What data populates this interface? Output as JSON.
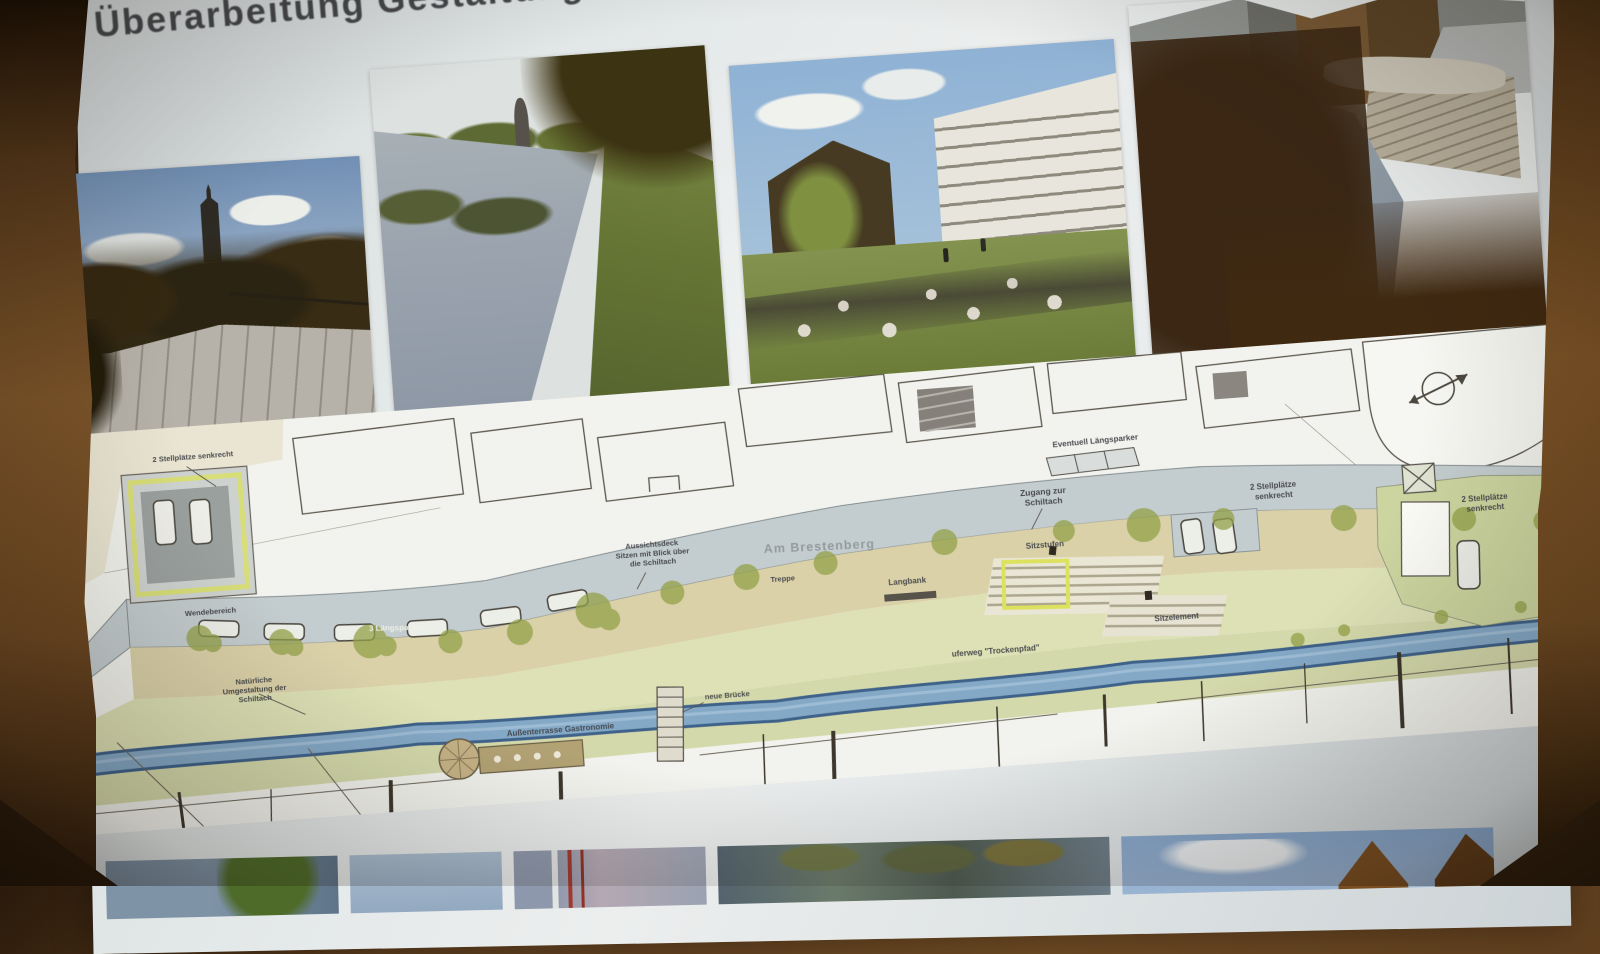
{
  "slide": {
    "title": "Überarbeitung Gestaltung"
  },
  "photos_top": [
    {
      "name": "deck-church-tower"
    },
    {
      "name": "river-bank"
    },
    {
      "name": "apartments-stream"
    },
    {
      "name": "stream-stone-steps"
    }
  ],
  "photos_bottom": [
    {
      "name": "water-tree"
    },
    {
      "name": "sky"
    },
    {
      "name": "facade-detail"
    },
    {
      "name": "river-reflections"
    },
    {
      "name": "sky-gabled-houses"
    }
  ],
  "plan": {
    "street_name": "Am Brestenberg",
    "labels": {
      "stellplaetze_left": "2 Stellplätze senkrecht",
      "wendebereich": "Wendebereich",
      "laengsparker_street": "3 Längsparker",
      "natuerliche_umgestaltung": "Natürliche\nUmgestaltung der\nSchiltach",
      "aussichtsdeck": "Aussichtsdeck\nSitzen mit Blick über\ndie Schiltach",
      "treppe": "Treppe",
      "aussenterrasse": "Außenterrasse Gastronomie",
      "neue_bruecke": "neue Brücke",
      "langbank": "Langbank",
      "sitzstufen": "Sitzstufen",
      "sitzelement": "Sitzelement",
      "uferweg": "uferweg \"Trockenpfad\"",
      "zugang": "Zugang zur\nSchiltach",
      "eventuell_laengsparker": "Eventuell Längsparker",
      "stellplaetze_mid": "2 Stellplätze\nsenkrecht",
      "stellplaetze_right": "2 Stellplätze\nsenkrecht"
    },
    "colors": {
      "street": "#c3ccce",
      "promenade": "#d8cfa4",
      "stream": "#84a9c7",
      "bank": "#dde1b5",
      "vegetation": "#93a148",
      "highlight_yellow": "#dde25e"
    }
  }
}
